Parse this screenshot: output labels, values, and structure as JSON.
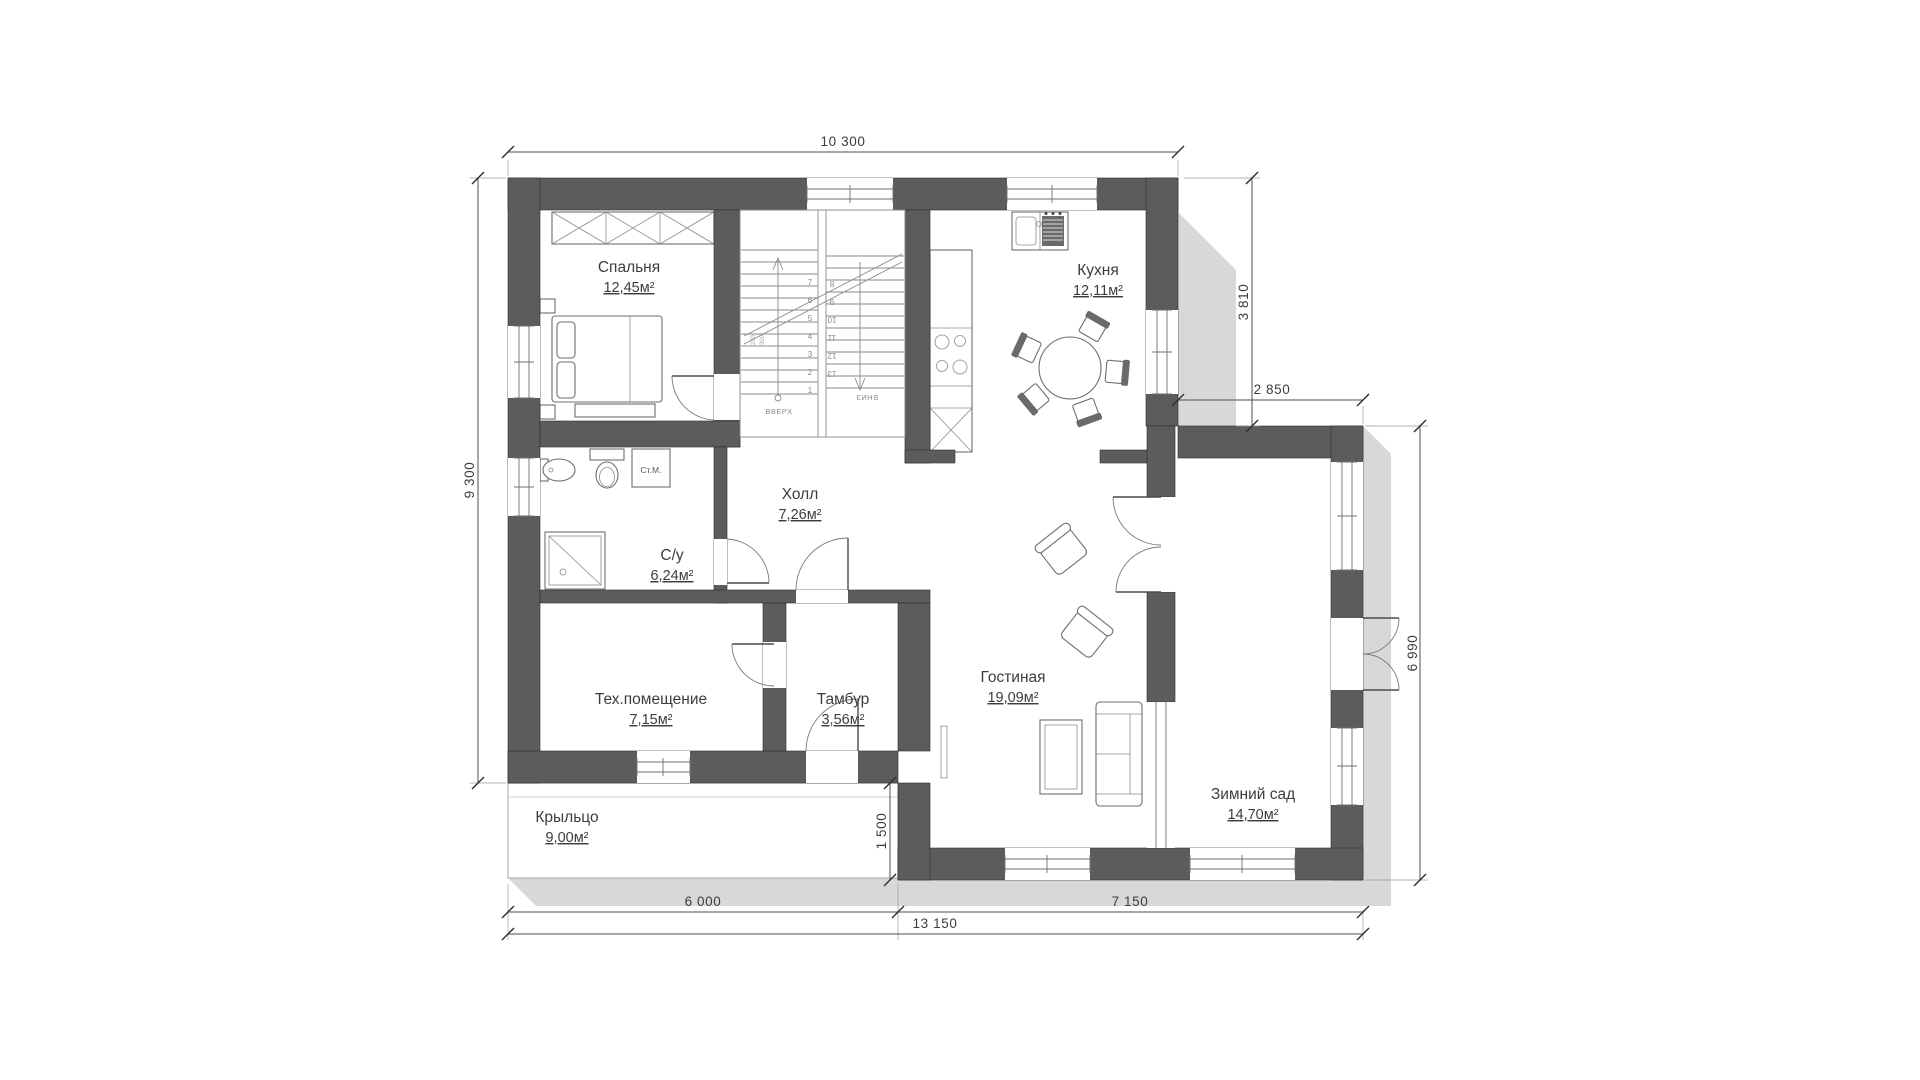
{
  "plan": {
    "rooms": [
      {
        "name": "Спальня",
        "area": "12,45м²"
      },
      {
        "name": "Кухня",
        "area": "12,11м²"
      },
      {
        "name": "С/у",
        "area": "6,24м²"
      },
      {
        "name": "Холл",
        "area": "7,26м²"
      },
      {
        "name": "Тех.помещение",
        "area": "7,15м²"
      },
      {
        "name": "Тамбур",
        "area": "3,56м²"
      },
      {
        "name": "Гостиная",
        "area": "19,09м²"
      },
      {
        "name": "Зимний сад",
        "area": "14,70м²"
      },
      {
        "name": "Крыльцо",
        "area": "9,00м²"
      }
    ],
    "dimensions": {
      "top": "10 300",
      "left": "9 300",
      "kitchen_right": "3 810",
      "wing_top": "2 850",
      "wing_right": "6 990",
      "porch_offset": "1 500",
      "bottom_left": "6 000",
      "bottom_right": "7 150",
      "bottom_total": "13 150"
    },
    "stairs": {
      "up_label": "ВВЕРХ",
      "down_label": "ВНИЗ",
      "steps": [
        "1",
        "2",
        "3",
        "4",
        "5",
        "6",
        "7",
        "8",
        "9",
        "10",
        "11",
        "12",
        "13"
      ],
      "riser_note": "290",
      "tread_note": "300"
    },
    "appliances": {
      "washing_machine": "Ст.М."
    },
    "colors": {
      "wall": "#5c5c5c",
      "shadow": "#d8d8d8",
      "text": "#3d3d3d",
      "line": "#6e6e6e",
      "background": "#ffffff"
    }
  }
}
